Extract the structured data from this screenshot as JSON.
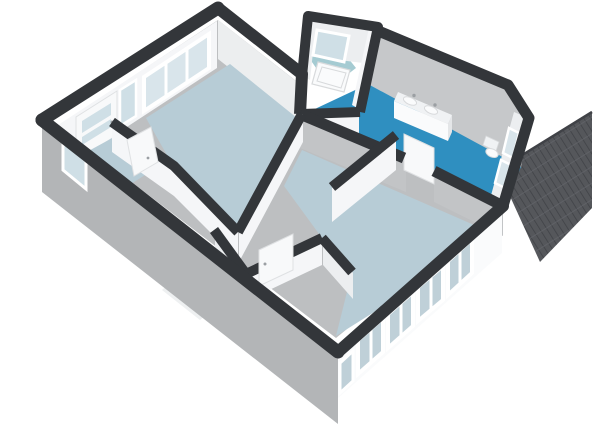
{
  "scene": {
    "description": "3D axonometric floor plan render of an apartment, viewed from above",
    "background": "#ffffff"
  },
  "colors": {
    "bg": "#ffffff",
    "wall_cap": "#33363a",
    "ext_sw": "#b3b5b7",
    "ext_se": "#fafbfc",
    "int_white": "#f5f6f8",
    "int_light": "#eceef0",
    "ne_face": "#eceeef",
    "face_gray": "#c6c8ca",
    "face_gray2": "#c2c4c6",
    "floor_hall": "#bdbfc1",
    "floor_light": "#b7ccd6",
    "floor_blue": "#2f8fc0",
    "floor_teal": "#a5cbd2",
    "glass": "#d9e5eb",
    "glass_light": "#cfdfe6",
    "glass_se": "#bfd0d8",
    "roof_base": "#55575b",
    "roof_line": "#404247",
    "roof_row": "#63656a",
    "fixture_white": "#fafbfc",
    "fixture_top": "#f0f2f4",
    "fixture_side": "#e4e6e8",
    "fixture_edge": "#d8dadc",
    "door_leaf": "#f8f9fa",
    "door_edge": "#dfe1e3",
    "metal": "#9b9fa3",
    "frame_white": "#ffffff",
    "open_door": "#eef0f1"
  },
  "counts": {
    "se_facade_windows": 5,
    "bedroom_window_panes": 3,
    "bathroom_end_windows": 2,
    "vanity_sinks": 2
  },
  "fixtures": {
    "vanity": "double-sink-vanity",
    "toilet": "toilet",
    "bathtub": "bathtub",
    "front_door": "glazed-front-door",
    "interior_doors": 3
  }
}
